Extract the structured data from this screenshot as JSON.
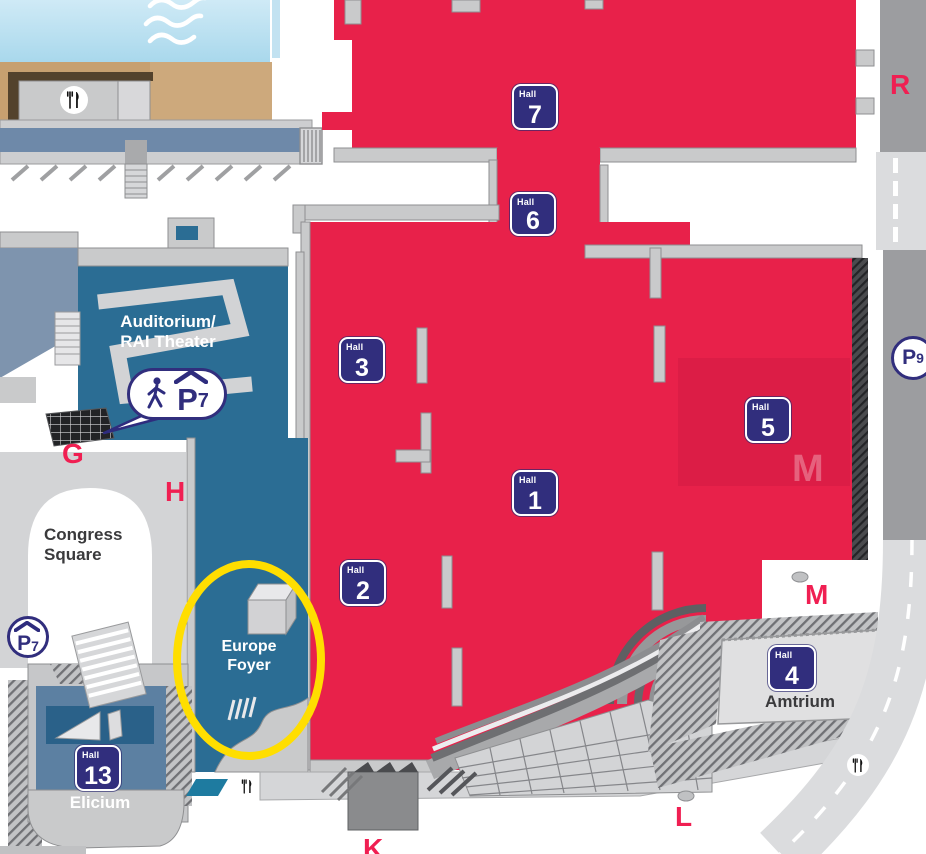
{
  "halls": [
    {
      "word": "Hall",
      "number": "7"
    },
    {
      "word": "Hall",
      "number": "6"
    },
    {
      "word": "Hall",
      "number": "3"
    },
    {
      "word": "Hall",
      "number": "1"
    },
    {
      "word": "Hall",
      "number": "2"
    },
    {
      "word": "Hall",
      "number": "5"
    },
    {
      "word": "Hall",
      "number": "4"
    },
    {
      "word": "Hall",
      "number": "13"
    }
  ],
  "buildings": {
    "auditorium_line1": "Auditorium/",
    "auditorium_line2": "RAI Theater",
    "congress_line1": "Congress",
    "congress_line2": "Square",
    "europe_line1": "Europe",
    "europe_line2": "Foyer",
    "amtrium": "Amtrium",
    "elicium": "Elicium"
  },
  "entrances": {
    "g": "G",
    "h": "H",
    "k": "K",
    "l": "L",
    "m": "M",
    "r": "R",
    "m_watermark": "M"
  },
  "parking": {
    "p7_bubble": {
      "letter": "P",
      "number": "7"
    },
    "p7_circle": {
      "letter": "P",
      "number": "7"
    },
    "p9_circle": {
      "letter": "P",
      "number": "9"
    }
  },
  "icons": {
    "restaurant": "fork-and-knife",
    "waves": "water-waves",
    "pedestrian": "walking-person",
    "covered_parking": "roofed-parking-P"
  },
  "colors": {
    "hall_red": "#E8214A",
    "badge_indigo": "#312E7D",
    "building_blue": "#2B6D94",
    "elicium_blue": "#5C80A2",
    "highlight_yellow": "#FFDE00",
    "entrance_pink": "#F01F52"
  }
}
